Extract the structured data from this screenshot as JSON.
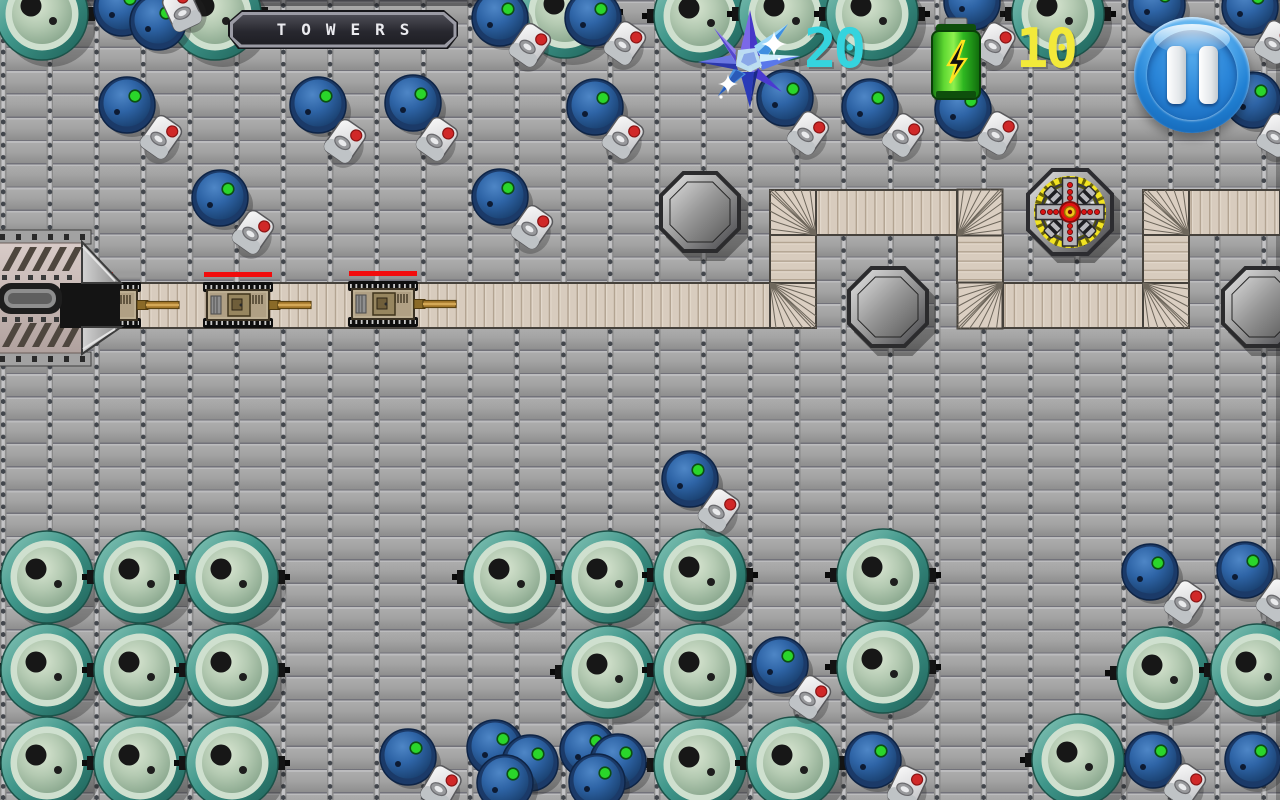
{
  "meta": {
    "width": 1280,
    "height": 800,
    "screen": "tower-defense level"
  },
  "hud": {
    "title_banner": {
      "text": "TOWERS"
    },
    "crystal_counter": {
      "icon": "crystal-star-icon",
      "value": "20",
      "color": "#35d4de"
    },
    "energy_counter": {
      "icon": "battery-icon",
      "value": "10",
      "color": "#f2e93a"
    },
    "pause_button": {
      "icon": "pause-icon"
    }
  },
  "palette": {
    "floor_gray": "#9c9c9c",
    "path_tan": "#d8ccbe",
    "path_stripe": "#b5a randomly692",
    "health_red": "#f20c0c",
    "teal_barrel": "#3f968a",
    "blue_barrel": "#2e64a6",
    "pause_blue": "#2181d4",
    "battery_green": "#5fd832",
    "crystal_blue": "#4636c8"
  },
  "map": {
    "tile": {
      "w": 46.7,
      "h": 23.3
    },
    "path": {
      "segments": [
        {
          "x": 112,
          "y": 283,
          "w": 658,
          "h": 45,
          "dir": "h"
        },
        {
          "x": 770,
          "y": 235,
          "w": 46,
          "h": 48,
          "dir": "v"
        },
        {
          "x": 816,
          "y": 190,
          "w": 141,
          "h": 45,
          "dir": "h"
        },
        {
          "x": 957,
          "y": 235,
          "w": 46,
          "h": 48,
          "dir": "v"
        },
        {
          "x": 1003,
          "y": 283,
          "w": 140,
          "h": 45,
          "dir": "h"
        },
        {
          "x": 1143,
          "y": 235,
          "w": 46,
          "h": 48,
          "dir": "v"
        },
        {
          "x": 1189,
          "y": 190,
          "w": 91,
          "h": 45,
          "dir": "h"
        }
      ],
      "corners": [
        {
          "x": 770,
          "y": 283,
          "o": "tl"
        },
        {
          "x": 770,
          "y": 190,
          "o": "br"
        },
        {
          "x": 957,
          "y": 190,
          "o": "bl"
        },
        {
          "x": 957,
          "y": 283,
          "o": "tr"
        },
        {
          "x": 1143,
          "y": 283,
          "o": "tl"
        },
        {
          "x": 1143,
          "y": 190,
          "o": "br"
        }
      ]
    },
    "base": {
      "x": -6,
      "y": 230
    },
    "tanks": [
      {
        "x": 106,
        "y": 305,
        "hp": 0.6
      },
      {
        "x": 238,
        "y": 305,
        "hp": 1
      },
      {
        "x": 383,
        "y": 304,
        "hp": 1
      }
    ],
    "tower_platforms": [
      {
        "x": 700,
        "y": 212
      },
      {
        "x": 888,
        "y": 307
      },
      {
        "x": 1262,
        "y": 307
      }
    ],
    "built_towers": [
      {
        "x": 1070,
        "y": 212,
        "type": "gatling"
      }
    ],
    "teal_barrels": [
      [
        42,
        14
      ],
      [
        215,
        14
      ],
      [
        565,
        12
      ],
      [
        700,
        16
      ],
      [
        785,
        14
      ],
      [
        872,
        14
      ],
      [
        1058,
        14
      ],
      [
        47,
        577
      ],
      [
        140,
        577
      ],
      [
        232,
        577
      ],
      [
        47,
        670
      ],
      [
        140,
        670
      ],
      [
        232,
        670
      ],
      [
        47,
        763
      ],
      [
        140,
        763
      ],
      [
        232,
        763
      ],
      [
        510,
        577
      ],
      [
        608,
        577
      ],
      [
        700,
        575
      ],
      [
        883,
        575
      ],
      [
        608,
        672
      ],
      [
        700,
        670
      ],
      [
        883,
        667
      ],
      [
        700,
        765
      ],
      [
        793,
        763
      ],
      [
        1163,
        673
      ],
      [
        1257,
        670
      ],
      [
        1078,
        760
      ]
    ],
    "blue_barrels": [
      [
        122,
        8
      ],
      [
        158,
        22
      ],
      [
        500,
        18
      ],
      [
        593,
        18
      ],
      [
        972,
        2
      ],
      [
        1157,
        5
      ],
      [
        1250,
        7
      ],
      [
        127,
        105
      ],
      [
        318,
        105
      ],
      [
        413,
        103
      ],
      [
        595,
        107
      ],
      [
        785,
        98
      ],
      [
        870,
        107
      ],
      [
        963,
        110
      ],
      [
        1253,
        100
      ],
      [
        220,
        198
      ],
      [
        500,
        197
      ],
      [
        690,
        479
      ],
      [
        780,
        665
      ],
      [
        873,
        760
      ],
      [
        408,
        757
      ],
      [
        495,
        748
      ],
      [
        530,
        763
      ],
      [
        505,
        783
      ],
      [
        588,
        750
      ],
      [
        618,
        762
      ],
      [
        597,
        782
      ],
      [
        1150,
        572
      ],
      [
        1245,
        570
      ],
      [
        1153,
        760
      ],
      [
        1253,
        760
      ]
    ],
    "canisters": [
      [
        182,
        10,
        -25
      ],
      [
        530,
        45,
        35
      ],
      [
        625,
        43,
        35
      ],
      [
        995,
        44,
        30
      ],
      [
        1275,
        42,
        30
      ],
      [
        161,
        137,
        35
      ],
      [
        345,
        141,
        35
      ],
      [
        437,
        139,
        35
      ],
      [
        623,
        137,
        35
      ],
      [
        808,
        133,
        35
      ],
      [
        903,
        135,
        35
      ],
      [
        998,
        133,
        30
      ],
      [
        1277,
        135,
        30
      ],
      [
        253,
        232,
        35
      ],
      [
        532,
        227,
        35
      ],
      [
        719,
        510,
        35
      ],
      [
        810,
        697,
        35
      ],
      [
        907,
        787,
        25
      ],
      [
        441,
        787,
        30
      ],
      [
        1185,
        602,
        35
      ],
      [
        1277,
        600,
        35
      ],
      [
        1185,
        785,
        35
      ]
    ]
  }
}
